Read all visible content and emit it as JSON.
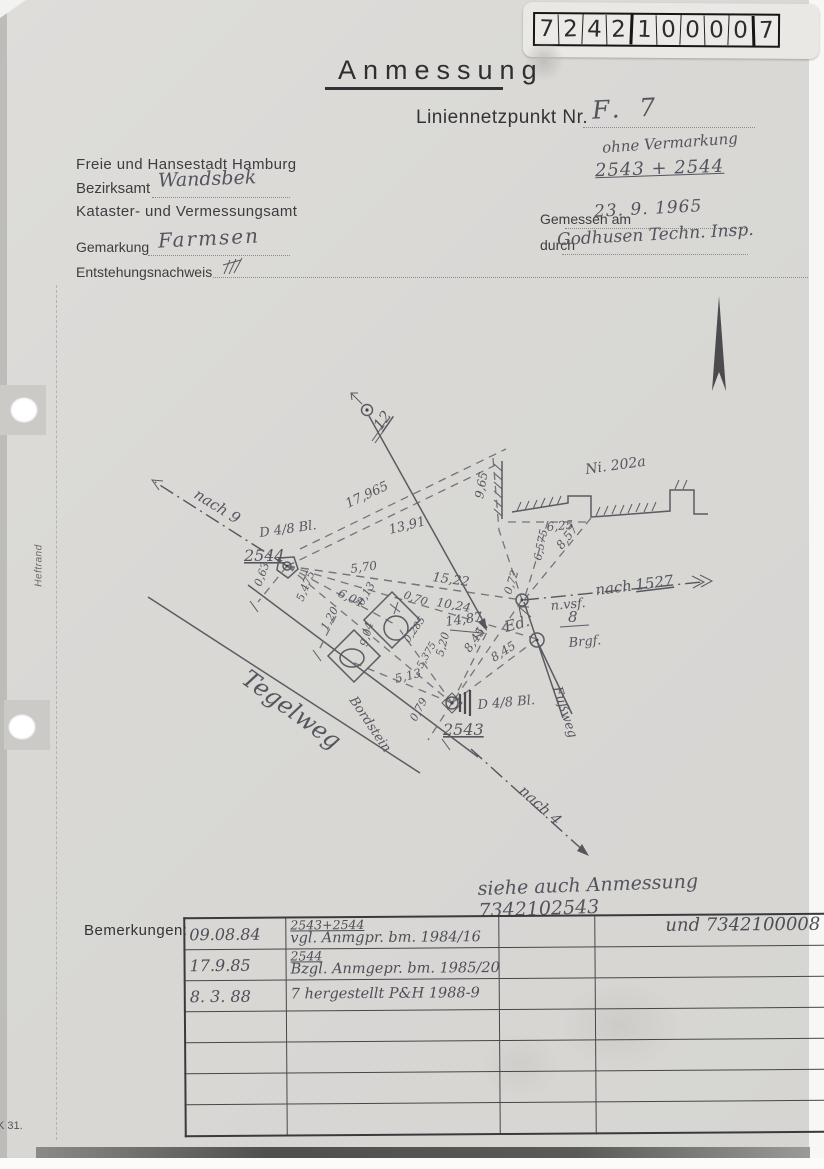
{
  "label_box": {
    "digits": [
      "7",
      "2",
      "4",
      "2",
      "1",
      "0",
      "0",
      "0",
      "0",
      "7"
    ]
  },
  "header": {
    "title": "Anmessung",
    "liniennetzpunkt_label": "Liniennetzpunkt Nr.",
    "liniennetzpunkt_value": "F. 7",
    "ohne_vermarkung": "ohne Vermarkung",
    "punkt_nummern": "2543 + 2544",
    "amt_line1": "Freie und Hansestadt Hamburg",
    "bezirksamt_label": "Bezirksamt",
    "bezirksamt_value": "Wandsbek",
    "amt_line3": "Kataster- und Vermessungsamt",
    "gemessen_label": "Gemessen am",
    "gemessen_value": "23. 9. 1965",
    "durch_label": "durch",
    "durch_value": "Godhusen Techn. Insp.",
    "gemarkung_label": "Gemarkung",
    "gemarkung_value": "Farmsen",
    "entstehung_label": "Entstehungsnachweis"
  },
  "margin": {
    "heftrand": "Heftrand",
    "footer_code": "K 31."
  },
  "sketch": {
    "labels": [
      {
        "t": "nach 9",
        "x": 193,
        "y": 497,
        "r": 32,
        "s": 15
      },
      {
        "t": "12",
        "x": 381,
        "y": 431,
        "r": -55,
        "s": 15,
        "u": 1
      },
      {
        "t": "17,965",
        "x": 348,
        "y": 508,
        "r": -25,
        "s": 13
      },
      {
        "t": "13,91",
        "x": 390,
        "y": 534,
        "r": -14,
        "s": 13
      },
      {
        "t": "Ni. 202a",
        "x": 586,
        "y": 474,
        "r": -8,
        "s": 14
      },
      {
        "t": "9,65",
        "x": 483,
        "y": 499,
        "r": -80,
        "s": 12
      },
      {
        "t": "6,25",
        "x": 547,
        "y": 531,
        "r": -5,
        "s": 12
      },
      {
        "t": "6,575",
        "x": 541,
        "y": 561,
        "r": -78,
        "s": 11
      },
      {
        "t": "8,57",
        "x": 562,
        "y": 550,
        "r": -52,
        "s": 12
      },
      {
        "t": "D 4/8 Bl.",
        "x": 260,
        "y": 537,
        "r": -8,
        "s": 13
      },
      {
        "t": "2544",
        "x": 244,
        "y": 561,
        "r": 0,
        "s": 16,
        "u": 1
      },
      {
        "t": "0,63",
        "x": 261,
        "y": 587,
        "r": -70,
        "s": 11
      },
      {
        "t": "5,70",
        "x": 351,
        "y": 573,
        "r": -8,
        "s": 12
      },
      {
        "t": "15,22",
        "x": 432,
        "y": 581,
        "r": 8,
        "s": 13
      },
      {
        "t": "6,04",
        "x": 337,
        "y": 596,
        "r": 25,
        "s": 12
      },
      {
        "t": "5,475",
        "x": 303,
        "y": 602,
        "r": -68,
        "s": 11
      },
      {
        "t": "10,24",
        "x": 436,
        "y": 606,
        "r": 10,
        "s": 12
      },
      {
        "t": "14,87",
        "x": 446,
        "y": 626,
        "r": -8,
        "s": 13
      },
      {
        "t": "0,72",
        "x": 511,
        "y": 595,
        "r": -72,
        "s": 11
      },
      {
        "t": "nach",
        "x": 596,
        "y": 595,
        "r": -7,
        "s": 15
      },
      {
        "t": "1527",
        "x": 636,
        "y": 590,
        "r": -7,
        "s": 15,
        "u": 1
      },
      {
        "t": "n.vsf.",
        "x": 551,
        "y": 610,
        "r": -5,
        "s": 13
      },
      {
        "t": "Ed.",
        "x": 506,
        "y": 632,
        "r": -15,
        "s": 15
      },
      {
        "t": "8",
        "x": 568,
        "y": 622,
        "r": 0,
        "s": 15
      },
      {
        "t": "Brgf.",
        "x": 569,
        "y": 647,
        "r": -5,
        "s": 13
      },
      {
        "t": "Fußweg",
        "x": 553,
        "y": 688,
        "r": 72,
        "s": 13
      },
      {
        "t": "0,70",
        "x": 403,
        "y": 598,
        "r": 18,
        "s": 11
      },
      {
        "t": "0,13",
        "x": 363,
        "y": 606,
        "r": -60,
        "s": 11
      },
      {
        "t": "1,20",
        "x": 327,
        "y": 631,
        "r": -62,
        "s": 11
      },
      {
        "t": "9,04",
        "x": 367,
        "y": 647,
        "r": -75,
        "s": 11
      },
      {
        "t": "0,285",
        "x": 409,
        "y": 643,
        "r": -55,
        "s": 10
      },
      {
        "t": "5,20",
        "x": 443,
        "y": 657,
        "r": -75,
        "s": 11
      },
      {
        "t": "8,45",
        "x": 470,
        "y": 653,
        "r": -55,
        "s": 12
      },
      {
        "t": "8,45",
        "x": 494,
        "y": 662,
        "r": -32,
        "s": 12
      },
      {
        "t": "5,375",
        "x": 422,
        "y": 669,
        "r": -60,
        "s": 10
      },
      {
        "t": "5,13",
        "x": 396,
        "y": 683,
        "r": -14,
        "s": 12
      },
      {
        "t": "Tegelweg",
        "x": 240,
        "y": 682,
        "r": 36,
        "s": 24
      },
      {
        "t": "Bordstein",
        "x": 349,
        "y": 700,
        "r": 56,
        "s": 13
      },
      {
        "t": "D 4/8 Bl.",
        "x": 478,
        "y": 709,
        "r": -5,
        "s": 13
      },
      {
        "t": "0,79",
        "x": 416,
        "y": 722,
        "r": -62,
        "s": 11
      },
      {
        "t": "2543",
        "x": 443,
        "y": 735,
        "r": 0,
        "s": 16,
        "u": 1
      },
      {
        "t": "nach 4",
        "x": 518,
        "y": 792,
        "r": 42,
        "s": 15
      }
    ]
  },
  "notes": {
    "siehe": "siehe auch Anmessung 7342102543"
  },
  "remarks": {
    "label": "Bemerkungen:",
    "rows": [
      {
        "date": "09.08.84",
        "text1": "2543+2544",
        "text2": "vgl. Anmgpr. bm. 1984/16",
        "right": "und 7342100008"
      },
      {
        "date": "17.9.85",
        "text1": "2544",
        "text2": "Bzgl. Anmgepr. bm. 1985/20",
        "right": ""
      },
      {
        "date": "8. 3. 88",
        "text1": "",
        "text2": "7 hergestellt P&H 1988-9",
        "right": ""
      },
      {
        "date": "",
        "text1": "",
        "text2": "",
        "right": ""
      },
      {
        "date": "",
        "text1": "",
        "text2": "",
        "right": ""
      },
      {
        "date": "",
        "text1": "",
        "text2": "",
        "right": ""
      },
      {
        "date": "",
        "text1": "",
        "text2": "",
        "right": ""
      }
    ]
  }
}
